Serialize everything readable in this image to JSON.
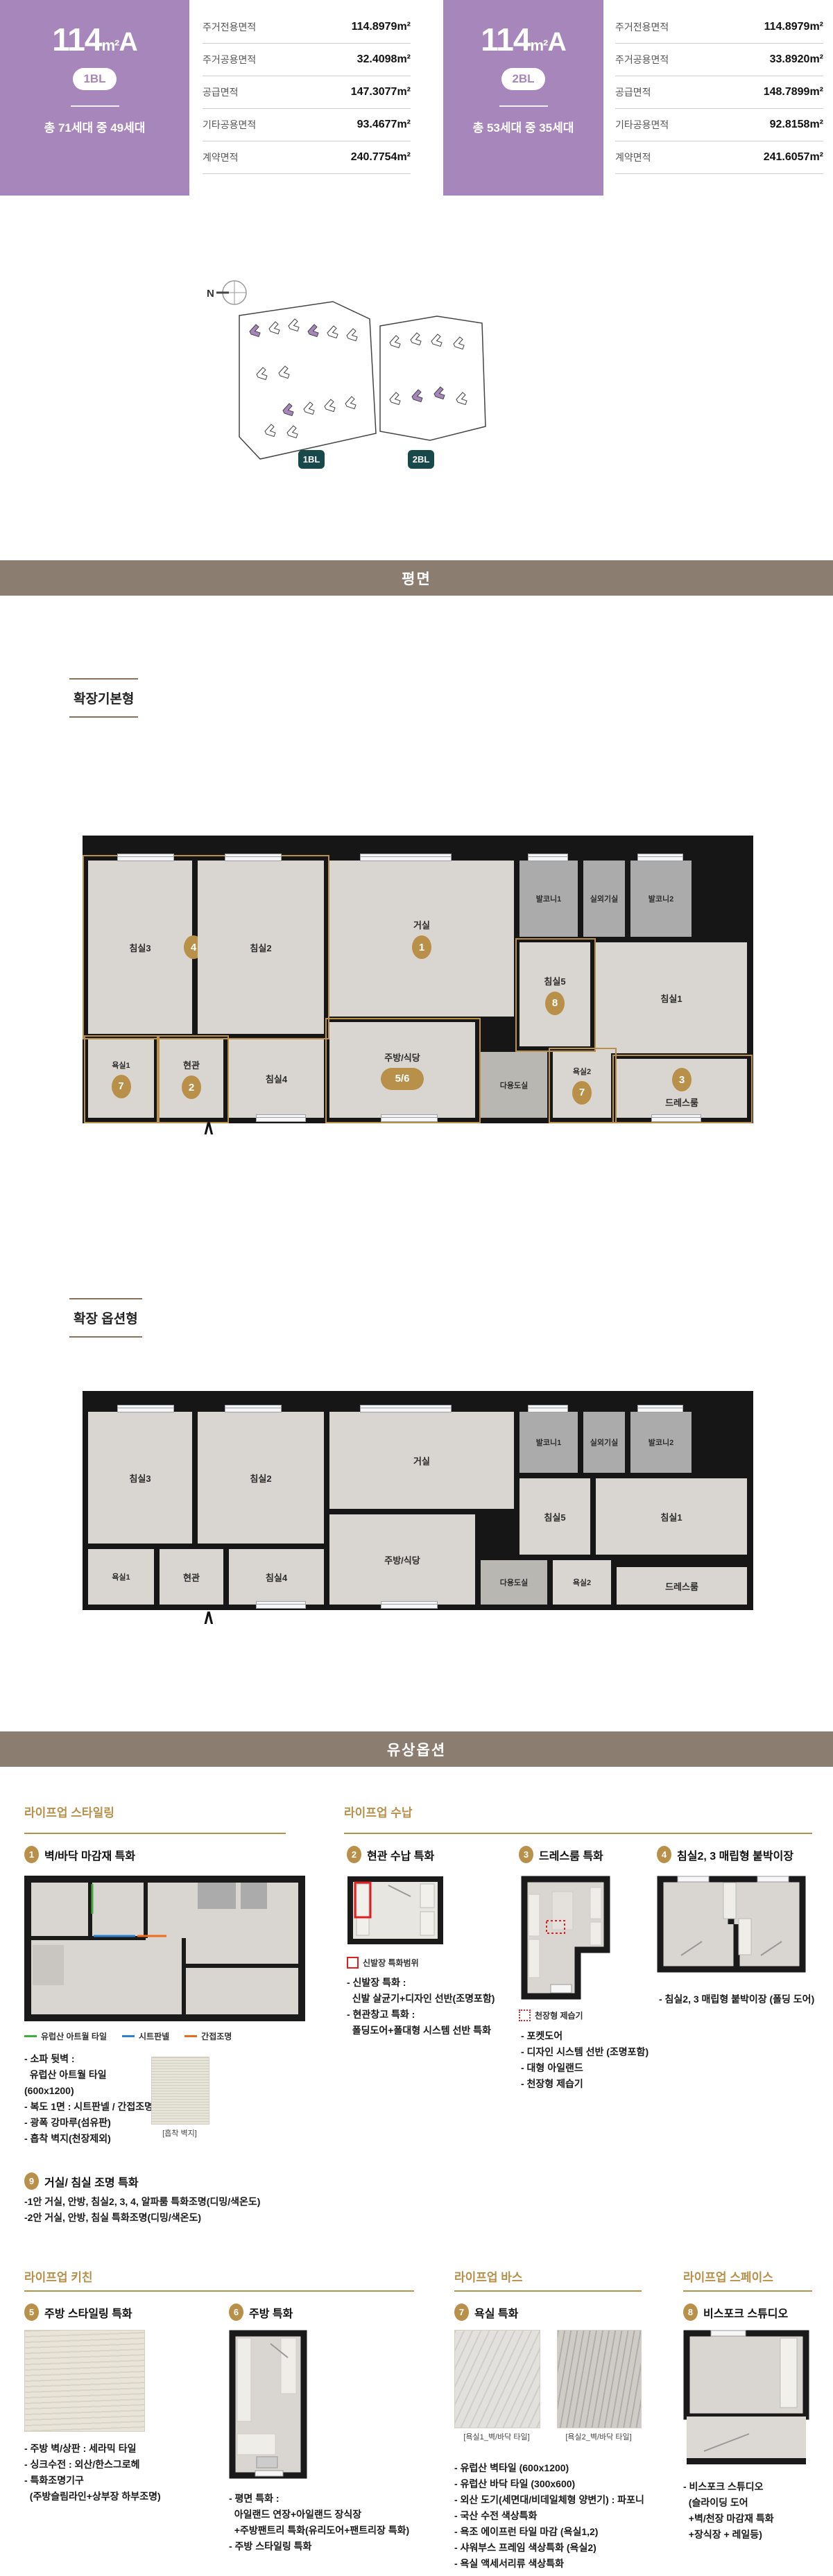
{
  "colors": {
    "purple": "#A786BB",
    "teal_badge": "#17494B",
    "gold": "#B9904A",
    "section_bar": "#8B7D70",
    "wall": "#161616",
    "floor": "#D9D6D2",
    "balcony": "#ABABAB",
    "red_highlight": "#E02020",
    "legend_green": "#3FAE3B",
    "legend_blue": "#2F80D0",
    "legend_orange": "#F06A1E"
  },
  "header": {
    "units": [
      {
        "size": "114",
        "unit_sup": "m²",
        "type": "A",
        "block": "1BL",
        "households": "총 71세대 중 49세대",
        "areas": [
          {
            "label": "주거전용면적",
            "value": "114.8979m²"
          },
          {
            "label": "주거공용면적",
            "value": "32.4098m²"
          },
          {
            "label": "공급면적",
            "value": "147.3077m²"
          },
          {
            "label": "기타공용면적",
            "value": "93.4677m²"
          },
          {
            "label": "계약면적",
            "value": "240.7754m²"
          }
        ]
      },
      {
        "size": "114",
        "unit_sup": "m²",
        "type": "A",
        "block": "2BL",
        "households": "총 53세대 중 35세대",
        "areas": [
          {
            "label": "주거전용면적",
            "value": "114.8979m²"
          },
          {
            "label": "주거공용면적",
            "value": "33.8920m²"
          },
          {
            "label": "공급면적",
            "value": "148.7899m²"
          },
          {
            "label": "기타공용면적",
            "value": "92.8158m²"
          },
          {
            "label": "계약면적",
            "value": "241.6057m²"
          }
        ]
      }
    ]
  },
  "site": {
    "north": "N",
    "badges": [
      "1BL",
      "2BL"
    ]
  },
  "sections": {
    "plan": "평면",
    "paid": "유상옵션"
  },
  "plans": [
    {
      "title": "확장기본형",
      "entrance": "∧",
      "rooms": [
        {
          "label": "침실3",
          "num": "4"
        },
        {
          "label": "침실2"
        },
        {
          "label": "거실",
          "num": "1"
        },
        {
          "label": "발코니1"
        },
        {
          "label": "실외기실"
        },
        {
          "label": "발코니2"
        },
        {
          "label": "침실5",
          "num": "8"
        },
        {
          "label": "침실1"
        },
        {
          "label": "욕실1",
          "num": "7"
        },
        {
          "label": "현관",
          "num": "2"
        },
        {
          "label": "침실4"
        },
        {
          "label": "주방/식당",
          "num": "5/6"
        },
        {
          "label": "다용도실"
        },
        {
          "label": "욕실2",
          "num": "7"
        },
        {
          "label": "드레스룸",
          "num": "3"
        }
      ]
    },
    {
      "title": "확장 옵션형",
      "entrance": "∧",
      "rooms": [
        {
          "label": "침실3"
        },
        {
          "label": "침실2"
        },
        {
          "label": "거실"
        },
        {
          "label": "발코니1"
        },
        {
          "label": "실외기실"
        },
        {
          "label": "발코니2"
        },
        {
          "label": "침실5"
        },
        {
          "label": "침실1"
        },
        {
          "label": "욕실1"
        },
        {
          "label": "현관"
        },
        {
          "label": "침실4"
        },
        {
          "label": "주방/식당"
        },
        {
          "label": "다용도실"
        },
        {
          "label": "욕실2"
        },
        {
          "label": "드레스룸"
        }
      ]
    }
  ],
  "options": {
    "groups": [
      {
        "title": "라이프업 스타일링"
      },
      {
        "title": "라이프업 수납"
      },
      {
        "title": "라이프업 키친"
      },
      {
        "title": "라이프업 바스"
      },
      {
        "title": "라이프업 스페이스"
      }
    ],
    "items": [
      {
        "num": "1",
        "title": "벽/바닥 마감재 특화",
        "legend": [
          {
            "label": "유럽산 아트월 타일",
            "color": "#3FAE3B"
          },
          {
            "label": "시트판넬",
            "color": "#2F80D0"
          },
          {
            "label": "간접조명",
            "color": "#F06A1E"
          }
        ],
        "details": [
          "- 소파 뒷벽 :",
          "  유럽산 아트월 타일(600x1200)",
          "- 복도 1면 : 시트판넬 / 간접조명",
          "- 광폭 강마루(섬유판)",
          "- 흡착 벽지(천장제외)"
        ],
        "caption": "[흡착 벽지]"
      },
      {
        "num": "2",
        "title": "현관 수납 특화",
        "legend_label": "신발장 특화범위",
        "details": [
          "- 신발장 특화 :",
          "  신발 살균기+디자인 선반(조명포함)",
          "- 현관창고 특화 :",
          "  폴딩도어+폴대형 시스템 선반 특화"
        ]
      },
      {
        "num": "3",
        "title": "드레스룸 특화",
        "legend_label": "천장형 제습기",
        "details": [
          "- 포켓도어",
          "- 디자인 시스템 선반 (조명포함)",
          "- 대형 아일랜드",
          "- 천장형 제습기"
        ]
      },
      {
        "num": "4",
        "title": "침실2, 3 매립형 붙박이장",
        "details": [
          "- 침실2, 3 매립형 붙박이장 (폴딩 도어)"
        ]
      },
      {
        "num": "9",
        "title": "거실/ 침실 조명 특화",
        "details": [
          "-1안 거실, 안방, 침실2, 3, 4, 알파룸 특화조명(디밍/색온도)",
          "-2안 거실, 안방, 침실 특화조명(디밍/색온도)"
        ]
      },
      {
        "num": "5",
        "title": "주방 스타일링 특화",
        "details": [
          "- 주방 벽/상판 : 세라믹 타일",
          "- 싱크수전 : 외산/한스그로헤",
          "- 특화조명기구",
          "  (주방슬림라인+상부장 하부조명)"
        ]
      },
      {
        "num": "6",
        "title": "주방 특화",
        "details": [
          "- 평면 특화 :",
          "  아일랜드 연장+아일랜드 장식장",
          "  +주방팬트리 특화(유리도어+팬트리장 특화)",
          "- 주방 스타일링 특화"
        ]
      },
      {
        "num": "7",
        "title": "욕실 특화",
        "captions": [
          "[욕실1_벽/바닥 타일]",
          "[욕실2_벽/바닥 타일]"
        ],
        "details": [
          "- 유럽산 벽타일 (600x1200)",
          "- 유럽산 바닥 타일 (300x600)",
          "- 외산 도기(세면대/비데일체형 양변기) : 파포니",
          "- 국산 수전 색상특화",
          "- 욕조 에이프런 타일 마감 (욕실1,2)",
          "- 샤워부스 프레임 색상특화 (욕실2)",
          "- 욕실 액세서리류 색상특화"
        ]
      },
      {
        "num": "8",
        "title": "비스포크 스튜디오",
        "details": [
          "- 비스포크 스튜디오",
          "  (슬라이딩 도어",
          "  +벽/천장 마감재 특화",
          "  +장식장 + 레일등)"
        ]
      }
    ]
  }
}
